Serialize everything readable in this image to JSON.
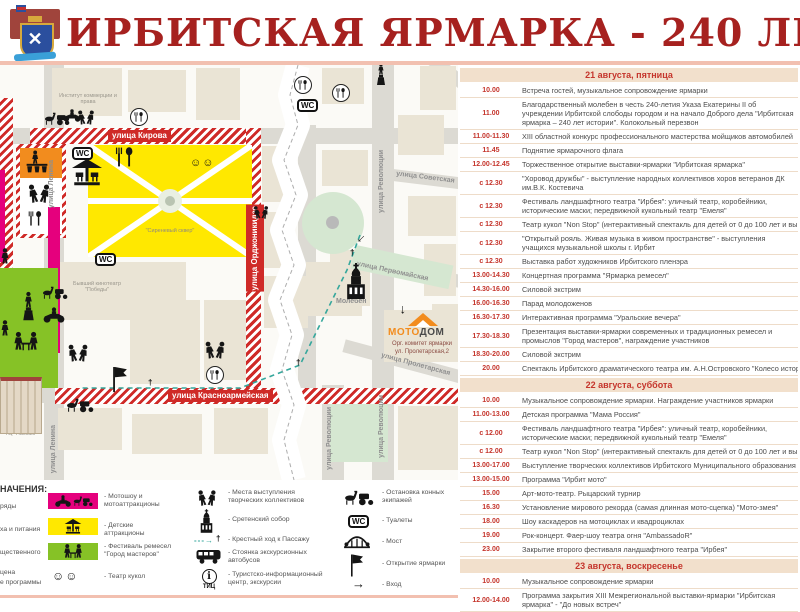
{
  "header": {
    "title": "ИРБИТСКАЯ ЯРМАРКА - 240 ЛЕТ ИСТОРИИ"
  },
  "colors": {
    "title_red": "#a6211f",
    "band_red": "#cf2a27",
    "magenta": "#e5007d",
    "yellow": "#ffe800",
    "green": "#86c226",
    "orange": "#f28c1e",
    "pale_green": "#d5e7d1",
    "schedule_red": "#c5352c"
  },
  "map": {
    "streets": {
      "kirova": "улица Кирова",
      "ordzhonikidze": "улица Орджоникидзе",
      "krasnoarmeyskaya": "улица Красноармейская",
      "lenina": "улица Ленина",
      "revolyutsii": "улица Революции",
      "sovetskaya": "улица Советская",
      "pervomayskaya": "улица Первомайская",
      "proletarskaya": "улица Пролетарская"
    },
    "labels": {
      "institute": "Институт коммерции и права",
      "square": "\"Сиреневый сквер\"",
      "cinema": "Бывший кинотеатр \"Победы\"",
      "moleben": "Молебен",
      "passage": "ТЦ \"Пассаж\"",
      "moto": "МОТО",
      "dom": "ДОМ",
      "org_committee": "Орг. комитет ярмарки",
      "org_address": "ул. Пролетарская,2",
      "wc": "WC",
      "tic": "ТИЦ",
      "info_i": "i"
    }
  },
  "legend": {
    "header_fragment": "НАЧЕНИЯ:",
    "col1": [
      {
        "label": "ряды"
      },
      {
        "label": "ха и питания"
      },
      {
        "label": "щественного"
      },
      {
        "line1": "цена",
        "line2": "е программы"
      }
    ],
    "col2": [
      {
        "label": "- Мотошоу и мотоаттракционы"
      },
      {
        "label": "- Детские аттракционы"
      },
      {
        "label": "- Фестиваль ремесел \"Город мастеров\""
      },
      {
        "label": "- Театр кукол"
      }
    ],
    "col3": [
      {
        "label": "- Места выступления творческих коллективов"
      },
      {
        "label": "- Сретенский собор"
      },
      {
        "label": "- Крестный ход к Пассажу"
      },
      {
        "label": "- Стоянка экскурсионных автобусов"
      },
      {
        "label": "- Туристско-информационный центр, экскурсии"
      }
    ],
    "col4": [
      {
        "label": "- Остановка конных экипажей"
      },
      {
        "label": "- Туалеты"
      },
      {
        "label": "- Мост"
      },
      {
        "label": "- Открытие ярмарки"
      },
      {
        "label": "- Вход"
      }
    ]
  },
  "schedule": {
    "days": [
      {
        "title": "21 августа, пятница",
        "rows": [
          {
            "t": "10.00",
            "d": "Встреча гостей, музыкальное сопровождение ярмарки"
          },
          {
            "t": "11.00",
            "d": "Благодарственный молебен в честь 240-летия Указа Екатерины II об учреждении Ирбитской слободы городом и на начало Доброго дела \"Ирбитская ярмарка – 240 лет истории\". Колокольный перезвон"
          },
          {
            "t": "11.00-11.30",
            "d": "XIII областной конкурс профессионального мастерства мойщиков автомобилей"
          },
          {
            "t": "11.45",
            "d": "Поднятие ярмарочного флага"
          },
          {
            "t": "12.00-12.45",
            "d": "Торжественное открытие выставки-ярмарки \"Ирбитская ярмарка\""
          },
          {
            "t": "с 12.30",
            "d": "\"Хоровод дружбы\" - выступление народных коллективов хоров ветеранов ДК им.В.К. Костевича"
          },
          {
            "t": "с 12.30",
            "d": "Фестиваль ландшафтного театра \"Ирбея\": уличный театр, коробейники, исторические маски; передвижной кукольный театр \"Емеля\""
          },
          {
            "t": "с 12.30",
            "d": "Театр кукол \"Non Stop\" (интерактивный спектакль для детей от 0 до 100 лет и выше)"
          },
          {
            "t": "с 12.30",
            "d": "\"Открытый рояль. Живая музыка в живом пространстве\" - выступления учащихся музыкальной школы г. Ирбит"
          },
          {
            "t": "с 12.30",
            "d": "Выставка работ художников Ирбитского пленэра"
          },
          {
            "t": "13.00-14.30",
            "d": "Концертная программа \"Ярмарка ремесел\""
          },
          {
            "t": "14.30-16.00",
            "d": "Силовой экстрим"
          },
          {
            "t": "16.00-16.30",
            "d": "Парад молодоженов"
          },
          {
            "t": "16.30-17.30",
            "d": "Интерактивная программа \"Уральские вечера\""
          },
          {
            "t": "17.30-18.30",
            "d": "Презентация выставки-ярмарки современных и традиционных ремесел и промыслов \"Город мастеров\", награждение участников"
          },
          {
            "t": "18.30-20.00",
            "d": "Силовой экстрим"
          },
          {
            "t": "20.00",
            "d": "Спектакль Ирбитского драматического театра им. А.Н.Островского \"Колесо истории\""
          }
        ]
      },
      {
        "title": "22 августа, суббота",
        "rows": [
          {
            "t": "10.00",
            "d": "Музыкальное сопровождение ярмарки. Награждение участников ярмарки"
          },
          {
            "t": "11.00-13.00",
            "d": "Детская программа \"Мама Россия\""
          },
          {
            "t": "с 12.00",
            "d": "Фестиваль ландшафтного театра \"Ирбея\": уличный театр, коробейники, исторические маски; передвижной кукольный театр \"Емеля\""
          },
          {
            "t": "с 12.00",
            "d": "Театр кукол \"Non Stop\" (интерактивный спектакль для детей от 0 до 100 лет и выше)"
          },
          {
            "t": "13.00-17.00",
            "d": "Выступление творческих коллективов Ирбитского Муниципального образования"
          },
          {
            "t": "13.00-15.00",
            "d": "Программа \"Ирбит мото\""
          },
          {
            "t": "15.00",
            "d": "Арт-мото-театр. Рыцарский турнир"
          },
          {
            "t": "16.30",
            "d": "Установление мирового рекорда (самая длинная мото-сцепка) \"Мото-змея\""
          },
          {
            "t": "18.00",
            "d": "Шоу каскадеров на мотоциклах и квадроциклах"
          },
          {
            "t": "19.00",
            "d": "Рок-концерт. Фаер-шоу театра огня \"AmbassadoR\""
          },
          {
            "t": "23.00",
            "d": "Закрытие второго фестиваля ландшафтного театра \"Ирбея\""
          }
        ]
      },
      {
        "title": "23 августа, воскресенье",
        "rows": [
          {
            "t": "10.00",
            "d": "Музыкальное сопровождение ярмарки"
          },
          {
            "t": "12.00-14.00",
            "d": "Программа закрытия XIII Межрегиональной выставки-ярмарки \"Ирбитская ярмарка\" - \"До новых встреч\""
          }
        ]
      }
    ]
  }
}
